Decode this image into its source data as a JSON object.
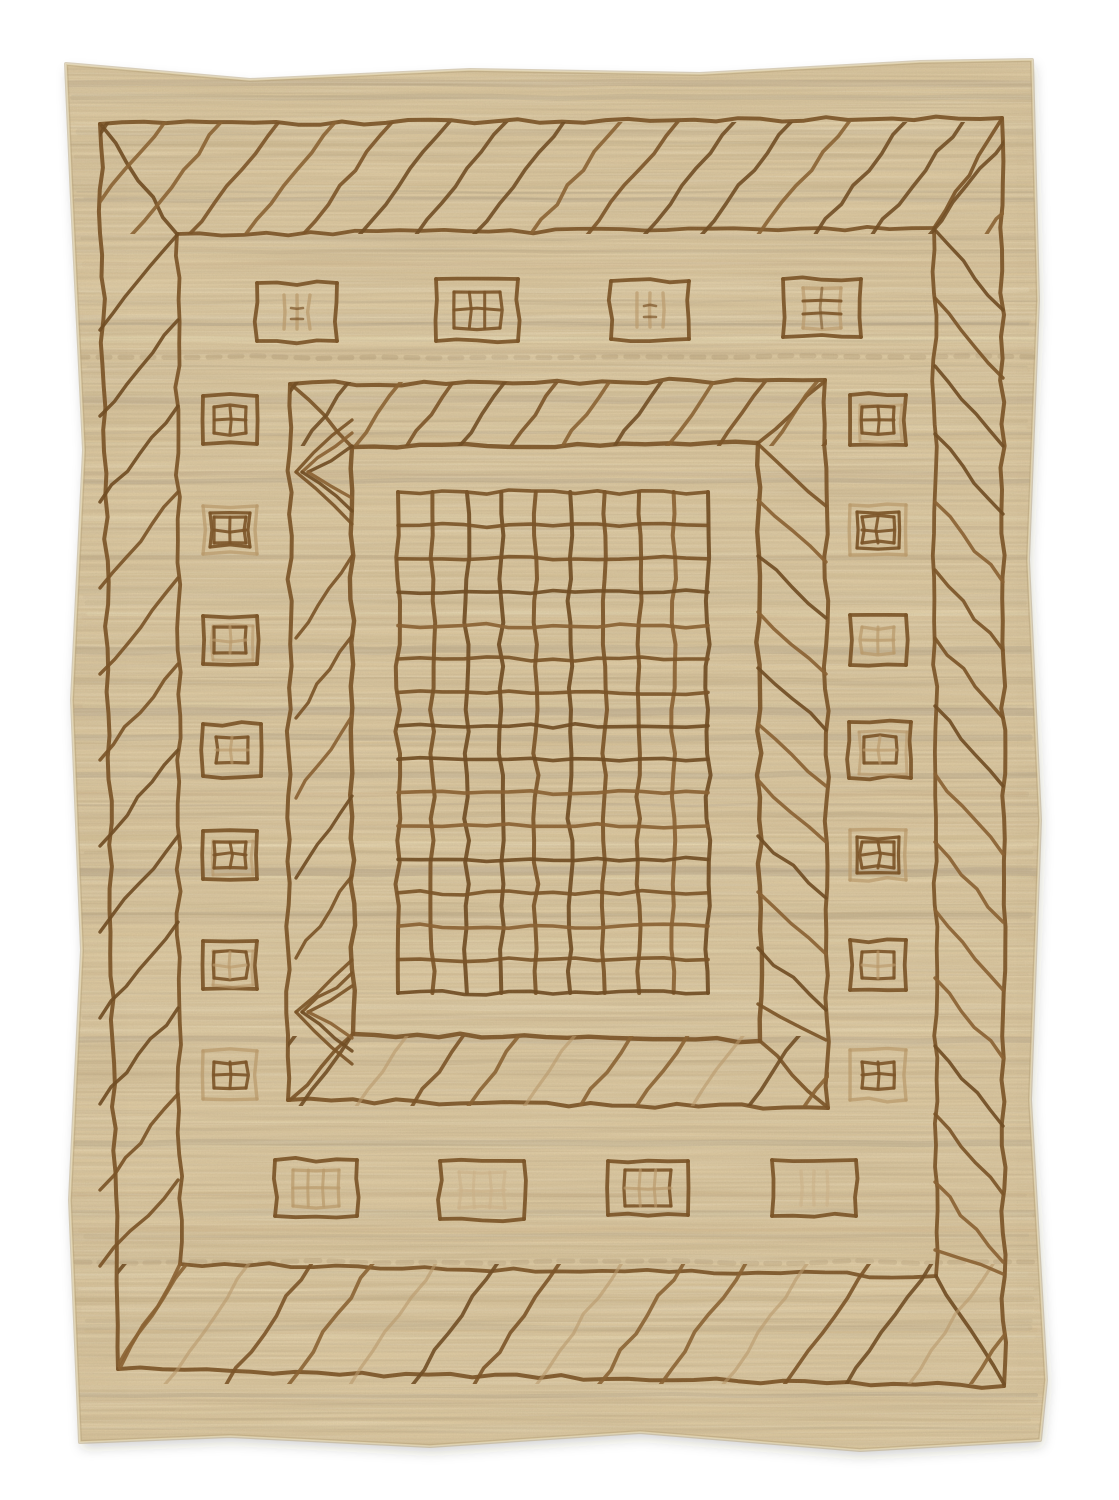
{
  "scene": {
    "subject": "Photograph of a handwoven natural beige wool rug with hand-drawn brown geometric pattern: nested rectangular borders with diagonal hatching, rows of small window motifs, and a central grid panel",
    "background_color": "#ffffff",
    "width": 1119,
    "height": 1500
  },
  "palette": {
    "rug_base": "#dcc8a0",
    "rug_light": "#ebdfb9",
    "rug_cream": "#f1e5c2",
    "rug_dark": "#b9a47e",
    "rug_gray": "#a99c86",
    "rug_warm": "#d2b98e",
    "line_brown": "#7a5124",
    "line_brown2": "#8a6030",
    "line_tan": "#bb9a6a",
    "line_faint": "#cdb389",
    "shadow": "#3a3223"
  },
  "rug": {
    "outline": [
      [
        66,
        64
      ],
      [
        250,
        80
      ],
      [
        470,
        70
      ],
      [
        700,
        74
      ],
      [
        920,
        62
      ],
      [
        1032,
        60
      ],
      [
        1038,
        300
      ],
      [
        1028,
        560
      ],
      [
        1040,
        820
      ],
      [
        1030,
        1100
      ],
      [
        1046,
        1380
      ],
      [
        1040,
        1440
      ],
      [
        860,
        1450
      ],
      [
        640,
        1432
      ],
      [
        430,
        1446
      ],
      [
        230,
        1436
      ],
      [
        80,
        1442
      ],
      [
        70,
        1200
      ],
      [
        82,
        950
      ],
      [
        72,
        700
      ],
      [
        84,
        450
      ],
      [
        72,
        200
      ]
    ]
  },
  "borders": {
    "outer": [
      [
        100,
        124
      ],
      [
        1002,
        118
      ],
      [
        1004,
        1386
      ],
      [
        118,
        1369
      ]
    ],
    "second": [
      [
        177,
        234
      ],
      [
        934,
        228
      ],
      [
        936,
        1276
      ],
      [
        180,
        1264
      ]
    ],
    "middle": [
      [
        290,
        384
      ],
      [
        825,
        380
      ],
      [
        828,
        1108
      ],
      [
        288,
        1100
      ]
    ],
    "panel": [
      [
        352,
        447
      ],
      [
        758,
        443
      ],
      [
        760,
        1041
      ],
      [
        353,
        1034
      ]
    ]
  },
  "miters": [
    [
      177,
      234,
      102,
      126
    ],
    [
      934,
      228,
      1001,
      120
    ],
    [
      936,
      1276,
      1004,
      1384
    ],
    [
      180,
      1264,
      120,
      1368
    ],
    [
      352,
      447,
      293,
      386
    ],
    [
      758,
      443,
      824,
      382
    ],
    [
      760,
      1041,
      826,
      1106
    ],
    [
      353,
      1034,
      290,
      1100
    ]
  ],
  "hatch_bands": [
    {
      "name": "outer-top",
      "mode": "fwd",
      "rect": [
        102,
        124,
        900,
        108
      ],
      "spacing": 57,
      "ratio": 0.8,
      "alt": false
    },
    {
      "name": "outer-bottom",
      "mode": "fwd",
      "rect": [
        120,
        1266,
        884,
        116
      ],
      "spacing": 62,
      "ratio": 0.7,
      "alt": true
    },
    {
      "name": "outer-left",
      "mode": "steps-fwd",
      "rect": [
        100,
        234,
        78,
        1032
      ],
      "step": 86,
      "drop": 96
    },
    {
      "name": "outer-right",
      "mode": "steps-back",
      "rect": [
        935,
        230,
        68,
        1044
      ],
      "step": 68,
      "drop": 80
    },
    {
      "name": "mid-top",
      "mode": "fwd",
      "rect": [
        292,
        384,
        533,
        60
      ],
      "spacing": 52,
      "ratio": 0.72,
      "alt": false
    },
    {
      "name": "mid-bottom",
      "mode": "fwd",
      "rect": [
        290,
        1038,
        537,
        66
      ],
      "spacing": 56,
      "ratio": 0.72,
      "alt": true
    },
    {
      "name": "mid-right",
      "mode": "steps-back",
      "rect": [
        758,
        444,
        68,
        596
      ],
      "step": 56,
      "drop": 62
    },
    {
      "name": "mid-left",
      "mode": "chevrons",
      "rect": [
        292,
        444,
        62,
        592
      ],
      "chevron_centers": [
        472,
        1012
      ],
      "steps_from": 556,
      "steps_to": 948,
      "step": 80,
      "drop": 82
    }
  ],
  "grid": {
    "x1": 398,
    "y1": 492,
    "x2": 708,
    "y2": 993,
    "v_lines": 10,
    "h_lines": 16
  },
  "motifs": {
    "top": [
      {
        "cx": 297,
        "cy": 312,
        "w": 80,
        "h": 58,
        "box": "brown",
        "glyph": "bars",
        "gc": "tan"
      },
      {
        "cx": 477,
        "cy": 310,
        "w": 82,
        "h": 62,
        "box": "brown",
        "glyph": "win6",
        "gc": "brown"
      },
      {
        "cx": 650,
        "cy": 310,
        "w": 78,
        "h": 58,
        "box": "brown",
        "glyph": "bars",
        "gc": "mix"
      },
      {
        "cx": 822,
        "cy": 308,
        "w": 78,
        "h": 58,
        "box": "brown",
        "glyph": "stack",
        "gc": "mix"
      }
    ],
    "bottom": [
      {
        "cx": 316,
        "cy": 1188,
        "w": 82,
        "h": 56,
        "box": "brown",
        "glyph": "win6",
        "gc": "tan"
      },
      {
        "cx": 482,
        "cy": 1190,
        "w": 84,
        "h": 58,
        "box": "brown",
        "glyph": "win6",
        "gc": "faint"
      },
      {
        "cx": 648,
        "cy": 1188,
        "w": 80,
        "h": 54,
        "box": "brown",
        "glyph": "win6",
        "gc": "mix"
      },
      {
        "cx": 814,
        "cy": 1188,
        "w": 84,
        "h": 56,
        "box": "brown",
        "glyph": "bars",
        "gc": "faint"
      }
    ],
    "left": [
      {
        "cx": 230,
        "cy": 420,
        "w": 54,
        "h": 48,
        "box": "brown",
        "glyph": "win4",
        "gc": "brown"
      },
      {
        "cx": 230,
        "cy": 530,
        "w": 54,
        "h": 48,
        "box": "tan2",
        "glyph": "win4",
        "gc": "brown"
      },
      {
        "cx": 230,
        "cy": 640,
        "w": 54,
        "h": 48,
        "box": "brown2",
        "glyph": "win4",
        "gc": "mix"
      },
      {
        "cx": 232,
        "cy": 750,
        "w": 58,
        "h": 52,
        "box": "brown",
        "glyph": "win4",
        "gc": "mix"
      },
      {
        "cx": 230,
        "cy": 855,
        "w": 54,
        "h": 48,
        "box": "brown2",
        "glyph": "win4",
        "gc": "brown"
      },
      {
        "cx": 230,
        "cy": 965,
        "w": 54,
        "h": 48,
        "box": "brown2",
        "glyph": "win4",
        "gc": "mix"
      },
      {
        "cx": 230,
        "cy": 1075,
        "w": 54,
        "h": 48,
        "box": "tan",
        "glyph": "win4",
        "gc": "brown"
      }
    ],
    "right": [
      {
        "cx": 878,
        "cy": 420,
        "w": 56,
        "h": 50,
        "box": "brown2",
        "glyph": "win4",
        "gc": "brown"
      },
      {
        "cx": 878,
        "cy": 530,
        "w": 56,
        "h": 50,
        "box": "tan2",
        "glyph": "win4",
        "gc": "brown"
      },
      {
        "cx": 878,
        "cy": 640,
        "w": 56,
        "h": 50,
        "box": "brown",
        "glyph": "win4",
        "gc": "tan"
      },
      {
        "cx": 880,
        "cy": 750,
        "w": 62,
        "h": 56,
        "box": "brown2",
        "glyph": "win4",
        "gc": "mix"
      },
      {
        "cx": 878,
        "cy": 855,
        "w": 56,
        "h": 50,
        "box": "tan2",
        "glyph": "win4",
        "gc": "brown"
      },
      {
        "cx": 878,
        "cy": 965,
        "w": 56,
        "h": 50,
        "box": "brown",
        "glyph": "win4",
        "gc": "mix"
      },
      {
        "cx": 878,
        "cy": 1075,
        "w": 56,
        "h": 50,
        "box": "tan",
        "glyph": "win4",
        "gc": "brown"
      }
    ]
  },
  "streaks": {
    "seed": 1337,
    "random_count": 150,
    "strong": [
      {
        "y": 200,
        "h": 4,
        "c": "rug_gray",
        "o": 0.25
      },
      {
        "y": 357,
        "h": 5,
        "c": "rug_dark",
        "o": 0.5,
        "dash": "12 10"
      },
      {
        "y": 650,
        "h": 8,
        "c": "rug_gray",
        "o": 0.3
      },
      {
        "y": 682,
        "h": 6,
        "c": "rug_dark",
        "o": 0.25
      },
      {
        "y": 712,
        "h": 8,
        "c": "rug_gray",
        "o": 0.35
      },
      {
        "y": 745,
        "h": 5,
        "c": "rug_warm",
        "o": 0.35
      },
      {
        "y": 775,
        "h": 6,
        "c": "rug_gray",
        "o": 0.3
      },
      {
        "y": 815,
        "h": 5,
        "c": "rug_dark",
        "o": 0.25
      },
      {
        "y": 872,
        "h": 8,
        "c": "rug_gray",
        "o": 0.35
      },
      {
        "y": 905,
        "h": 4,
        "c": "rug_dark",
        "o": 0.2
      },
      {
        "y": 1040,
        "h": 6,
        "c": "rug_gray",
        "o": 0.28
      },
      {
        "y": 1062,
        "h": 5,
        "c": "rug_dark",
        "o": 0.25
      },
      {
        "y": 1143,
        "h": 6,
        "c": "rug_gray",
        "o": 0.3
      },
      {
        "y": 1262,
        "h": 5,
        "c": "rug_dark",
        "o": 0.42,
        "dash": "14 9"
      },
      {
        "y": 1300,
        "h": 4,
        "c": "rug_warm",
        "o": 0.3
      },
      {
        "y": 1395,
        "h": 4,
        "c": "rug_gray",
        "o": 0.28
      }
    ]
  },
  "render": {
    "seed": 42,
    "wobble_amp": 2.4,
    "wobble_seg": 22
  }
}
